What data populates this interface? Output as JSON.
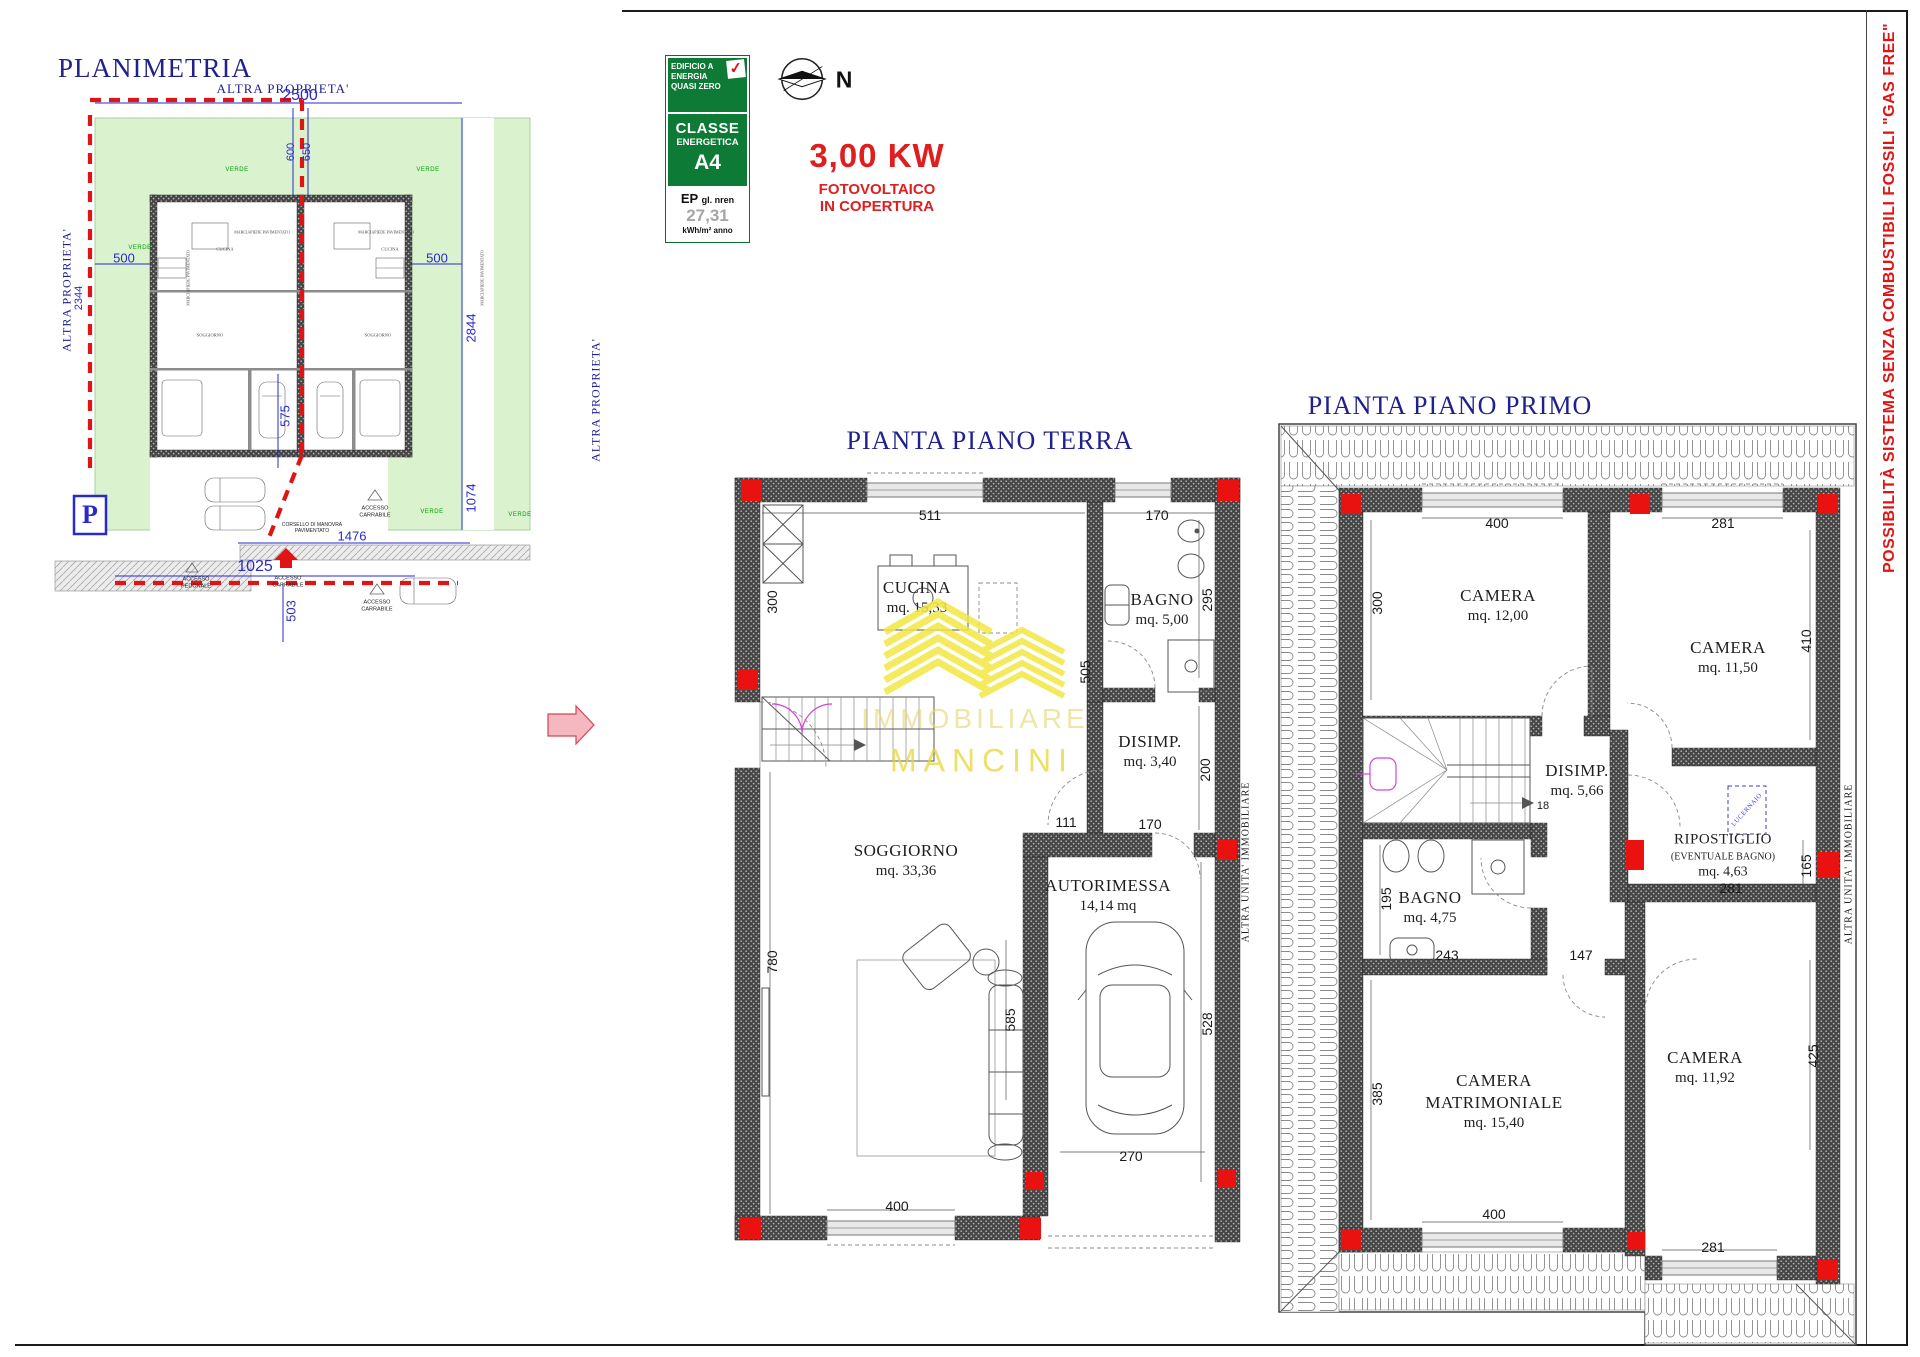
{
  "colors": {
    "navy": "#20208e",
    "red": "#e01414",
    "blue_dim": "#2a2acc",
    "badge_green": "#0d7a36",
    "verde": "#00a000",
    "watermark_yellow": "#e6d637"
  },
  "planimetria": {
    "title": "PLANIMETRIA",
    "altra_proprieta": "ALTRA PROPRIETA'",
    "verde": "VERDE",
    "marciapiede": "MARCIAPIEDE PAVIMENTATO",
    "accesso_pedonale": "ACCESSO PEDONALE",
    "accesso_carrabile": "ACCESSO CARRABILE",
    "corsello": "CORSELLO DI MANOVRA PAVIMENTATO",
    "parking": "P",
    "room_cucina": "CUCINA",
    "room_soggiorno": "SOGGIORNO",
    "dims": {
      "top": "2500",
      "gap_l": "600",
      "gap_r": "650",
      "side_l": "500",
      "side_r": "500",
      "left_v": "2344",
      "right_v": "2844",
      "drive": "575",
      "right_low": "1074",
      "bottom": "1025",
      "below": "503",
      "street": "1476"
    }
  },
  "energy_badge": {
    "header": "EDIFICIO A ENERGIA QUASI ZERO",
    "classe": "CLASSE",
    "energetica": "ENERGETICA",
    "klass": "A4",
    "ep_label": "EP",
    "ep_sub": "gl. nren",
    "ep_value": "27,31",
    "ep_unit": "kWh/m² anno",
    "check": "✓"
  },
  "compass": {
    "north": "N"
  },
  "fotovoltaico": {
    "power": "3,00 KW",
    "line1": "FOTOVOLTAICO",
    "line2": "IN COPERTURA"
  },
  "gas_free": "POSSIBILITÀ SISTEMA SENZA COMBUSTIBILI FOSSILI \"GAS FREE\"",
  "piano_terra": {
    "title": "PIANTA PIANO TERRA",
    "unit_label": "ALTRA UNITA' IMMOBILIARE",
    "rooms": [
      {
        "name": "CUCINA",
        "area": "mq. 15,33"
      },
      {
        "name": "BAGNO",
        "area": "mq. 5,00"
      },
      {
        "name": "DISIMP.",
        "area": "mq. 3,40"
      },
      {
        "name": "SOGGIORNO",
        "area": "mq. 33,36"
      },
      {
        "name": "AUTORIMESSA",
        "area": "14,14 mq"
      }
    ],
    "dims": {
      "cucina_w": "511",
      "bagno_win": "170",
      "cucina_l": "300",
      "bagno_h": "295",
      "cucina_h": "505",
      "disimp_h": "200",
      "pass": "111",
      "disimp_w": "170",
      "sogg_h": "780",
      "sogg_r": "585",
      "garage_h": "528",
      "sogg_win": "400",
      "garage_w": "270"
    }
  },
  "piano_primo": {
    "title": "PIANTA PIANO PRIMO",
    "unit_label": "ALTRA UNITA' IMMOBILIARE",
    "lucernaio": "LUCERNAIO",
    "stair_steps": "18",
    "rooms": [
      {
        "name": "CAMERA",
        "area": "mq. 12,00"
      },
      {
        "name": "CAMERA",
        "area": "mq. 11,50"
      },
      {
        "name": "DISIMP.",
        "area": "mq. 5,66"
      },
      {
        "name": "RIPOSTIGLIO",
        "sub": "(EVENTUALE BAGNO)",
        "area": "mq. 4,63"
      },
      {
        "name": "BAGNO",
        "area": "mq. 4,75"
      },
      {
        "name": "CAMERA",
        "name2": "MATRIMONIALE",
        "area": "mq. 15,40"
      },
      {
        "name": "CAMERA",
        "area": "mq. 11,92"
      }
    ],
    "dims": {
      "cam1_w": "400",
      "cam2_w": "281",
      "cam1_h": "300",
      "cam2_h": "410",
      "bagno_h": "195",
      "bagno_w": "243",
      "disimp_w": "147",
      "rip_h": "165",
      "rip_w": "281",
      "matr_h": "385",
      "cam3_h": "425",
      "cam3_w": "281",
      "matr_w": "400"
    }
  },
  "watermark": {
    "line1": "IMMOBILIARE",
    "line2": "MANCINI"
  }
}
